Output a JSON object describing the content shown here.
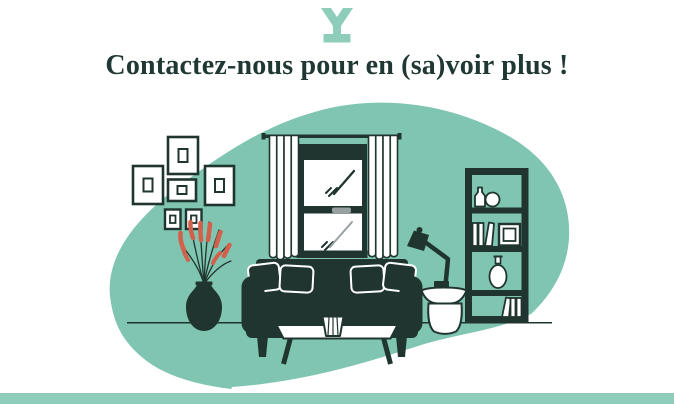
{
  "header": {
    "title": "Contactez-nous pour en (sa)voir plus !",
    "brand_icon": "y-brand-mark-icon"
  },
  "colors": {
    "teal": "#7FC5B1",
    "teal_light": "#8FCDBB",
    "dark": "#20352F",
    "red": "#D2604A",
    "gray": "#97A1A2",
    "heading_text": "#1F3833",
    "background": "#FFFFFF"
  },
  "illustration": {
    "alt": "Flat illustration of a living room on a teal organic blob: gallery wall of six picture frames, window with striped curtains, dark sofa with four cushions, white coffee table with a small pleated vase, plant with red leaves in a dark vase, bookshelf with books and vases, desk lamp on a round white side table",
    "objects": [
      "gallery-frames",
      "window",
      "curtains",
      "sofa",
      "cushions",
      "coffee-table",
      "plant-vase",
      "bookshelf",
      "desk-lamp",
      "side-table",
      "floor-line"
    ]
  }
}
